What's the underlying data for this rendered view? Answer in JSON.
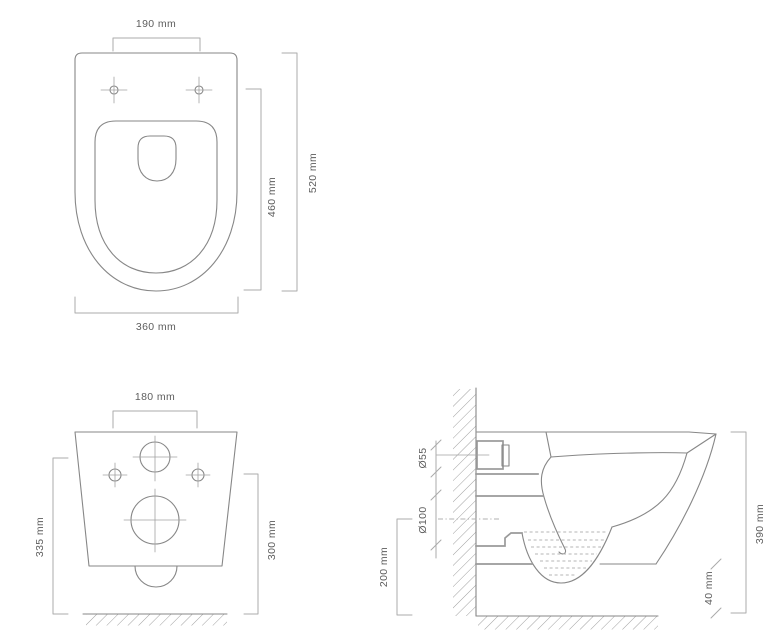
{
  "drawing": {
    "type": "technical dimension drawing",
    "subject": "wall-hung toilet",
    "colors": {
      "outline": "#878787",
      "dimension_line": "#ababab",
      "label_text": "#5d5d5d",
      "background": "#ffffff"
    },
    "views": {
      "top": {
        "title": "top view",
        "labels": {
          "hole_spacing": "190 mm",
          "total_depth": "520 mm",
          "seat_depth": "460 mm",
          "width": "360 mm"
        }
      },
      "back": {
        "title": "back view",
        "labels": {
          "bracket_width": "180 mm",
          "height_left": "335 mm",
          "height_right": "300 mm"
        }
      },
      "side": {
        "title": "side view",
        "labels": {
          "inlet_diameter": "Ø55",
          "outlet_diameter": "Ø100",
          "outlet_height": "200 mm",
          "total_height": "390 mm",
          "floor_gap": "40 mm"
        }
      }
    }
  }
}
